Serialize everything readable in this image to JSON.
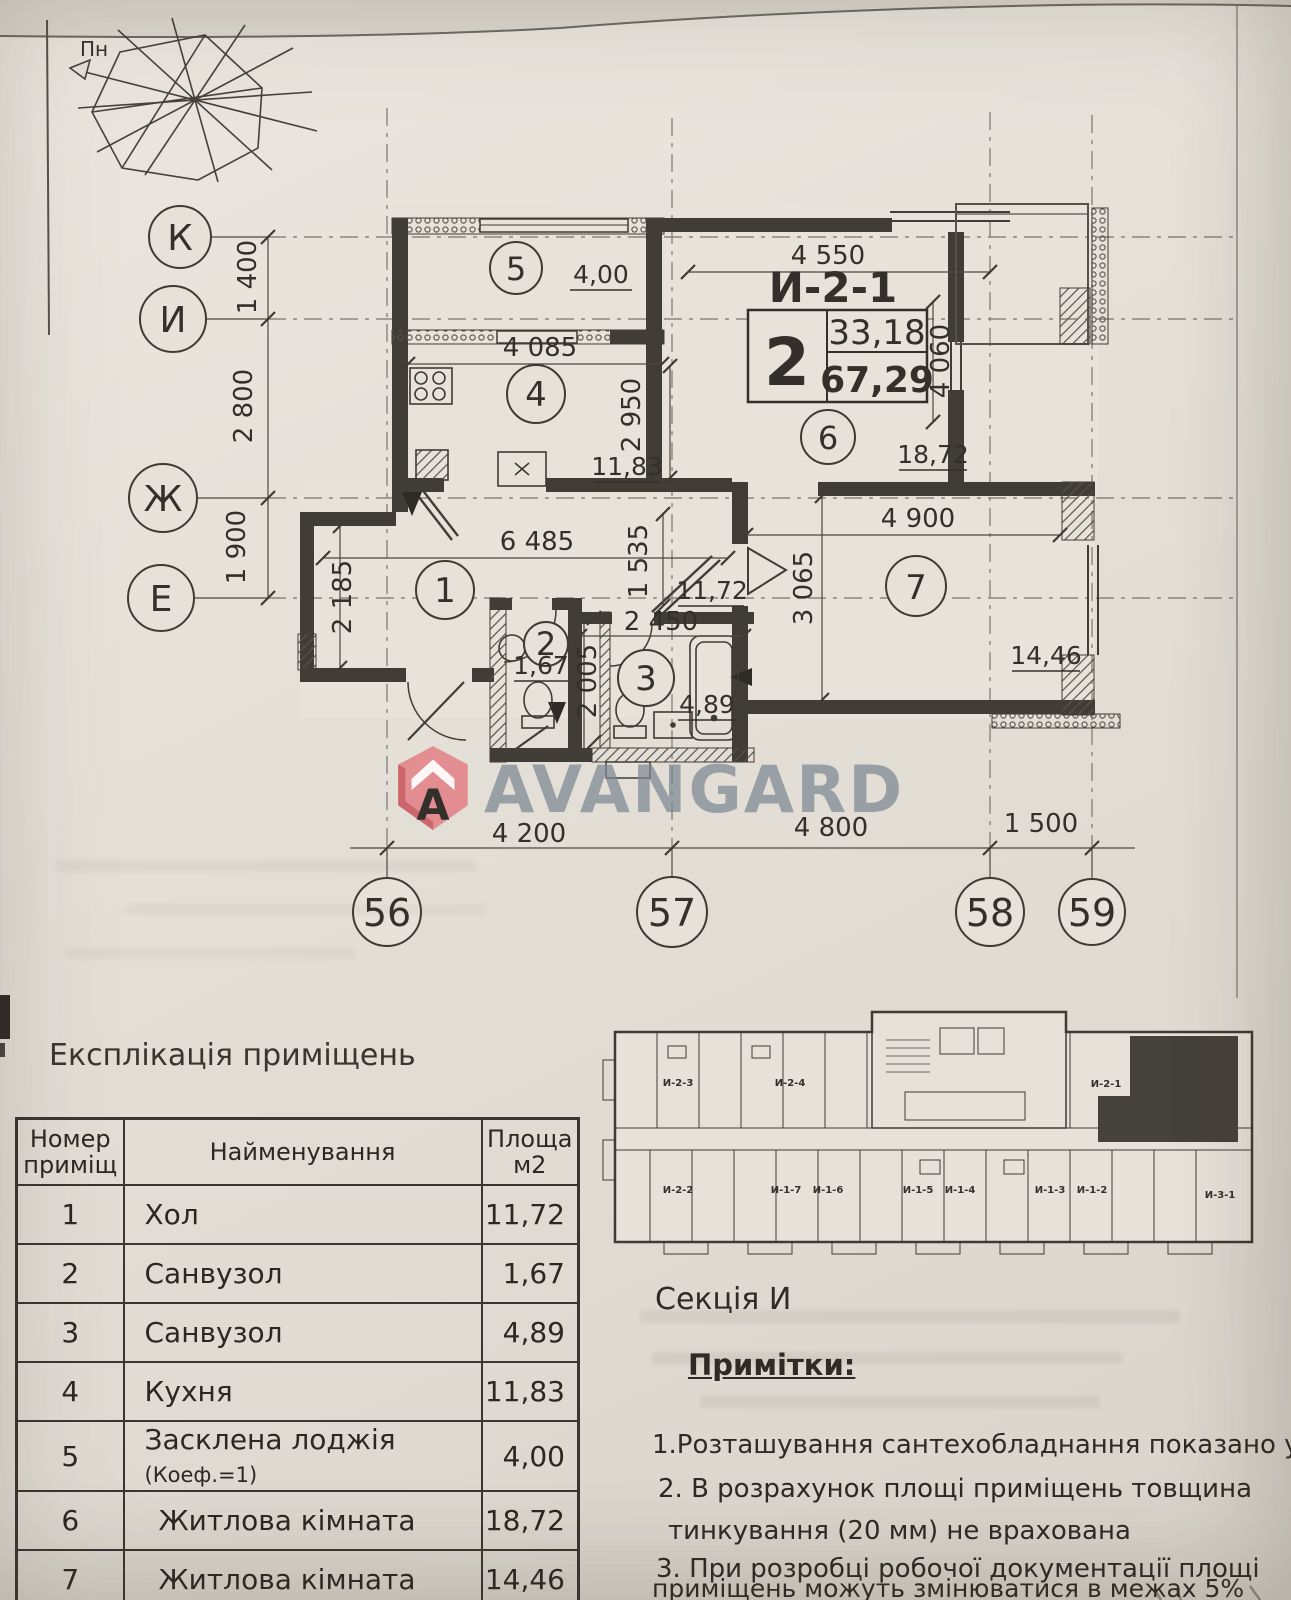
{
  "compass": {
    "north_label": "Пн"
  },
  "apartment": {
    "code": "И-2-1",
    "rooms_count": "2",
    "living_area": "33,18",
    "total_area": "67,29"
  },
  "axes": {
    "rows": [
      "К",
      "И",
      "Ж",
      "Е"
    ],
    "row_dims": [
      "1 400",
      "2 800",
      "1 900"
    ],
    "cols": [
      "56",
      "57",
      "58",
      "59"
    ],
    "col_dims": [
      "4 200",
      "4 800",
      "1 500"
    ]
  },
  "dimensions": {
    "room6_width": "4 550",
    "room6_height": "4 060",
    "kitchen_width": "4 085",
    "kitchen_height": "2 950",
    "hall_width": "6 485",
    "hall_height": "1 535",
    "hall_left_height": "2 185",
    "bath_width": "2 450",
    "bath_height": "2 005",
    "room7_width": "4 900",
    "room7_height": "3 065"
  },
  "rooms": [
    {
      "num": "1",
      "area": "11,72"
    },
    {
      "num": "2",
      "area": "1,67"
    },
    {
      "num": "3",
      "area": "4,89"
    },
    {
      "num": "4",
      "area": "11,83"
    },
    {
      "num": "5",
      "area": "4,00"
    },
    {
      "num": "6",
      "area": "18,72"
    },
    {
      "num": "7",
      "area": "14,46"
    }
  ],
  "logo": {
    "badge_letter": "A",
    "text": "AVANGARD"
  },
  "table": {
    "title": "Експлікація приміщень",
    "headers": {
      "num": "Номер приміщ",
      "name": "Найменування",
      "area": "Площа м2"
    },
    "rows": [
      {
        "num": "1",
        "name": "Хол",
        "note": "",
        "area": "11,72"
      },
      {
        "num": "2",
        "name": "Санвузол",
        "note": "",
        "area": "1,67"
      },
      {
        "num": "3",
        "name": "Санвузол",
        "note": "",
        "area": "4,89"
      },
      {
        "num": "4",
        "name": "Кухня",
        "note": "",
        "area": "11,83"
      },
      {
        "num": "5",
        "name": "Засклена лоджія",
        "note": "(Коеф.=1)",
        "area": "4,00"
      },
      {
        "num": "6",
        "name": "Житлова кімната",
        "note": "",
        "area": "18,72"
      },
      {
        "num": "7",
        "name": "Житлова кімната",
        "note": "",
        "area": "14,46"
      }
    ]
  },
  "section": {
    "label": "Секція И",
    "units": [
      "И-2-3",
      "И-2-4",
      "И-2-1",
      "И-2-2",
      "И-1-7",
      "И-1-6",
      "И-1-5",
      "И-1-4",
      "И-1-3",
      "И-1-2",
      "И-3-1"
    ]
  },
  "notes": {
    "title": "Примітки:",
    "lines": [
      "1.Розташування сантехобладнання показано умовно",
      "2. В розрахунок площі приміщень товщина",
      "тинкування (20 мм) не врахована",
      "3. При розробці робочої документації площі",
      "приміщень можуть змінюватися в межах 5%"
    ]
  }
}
